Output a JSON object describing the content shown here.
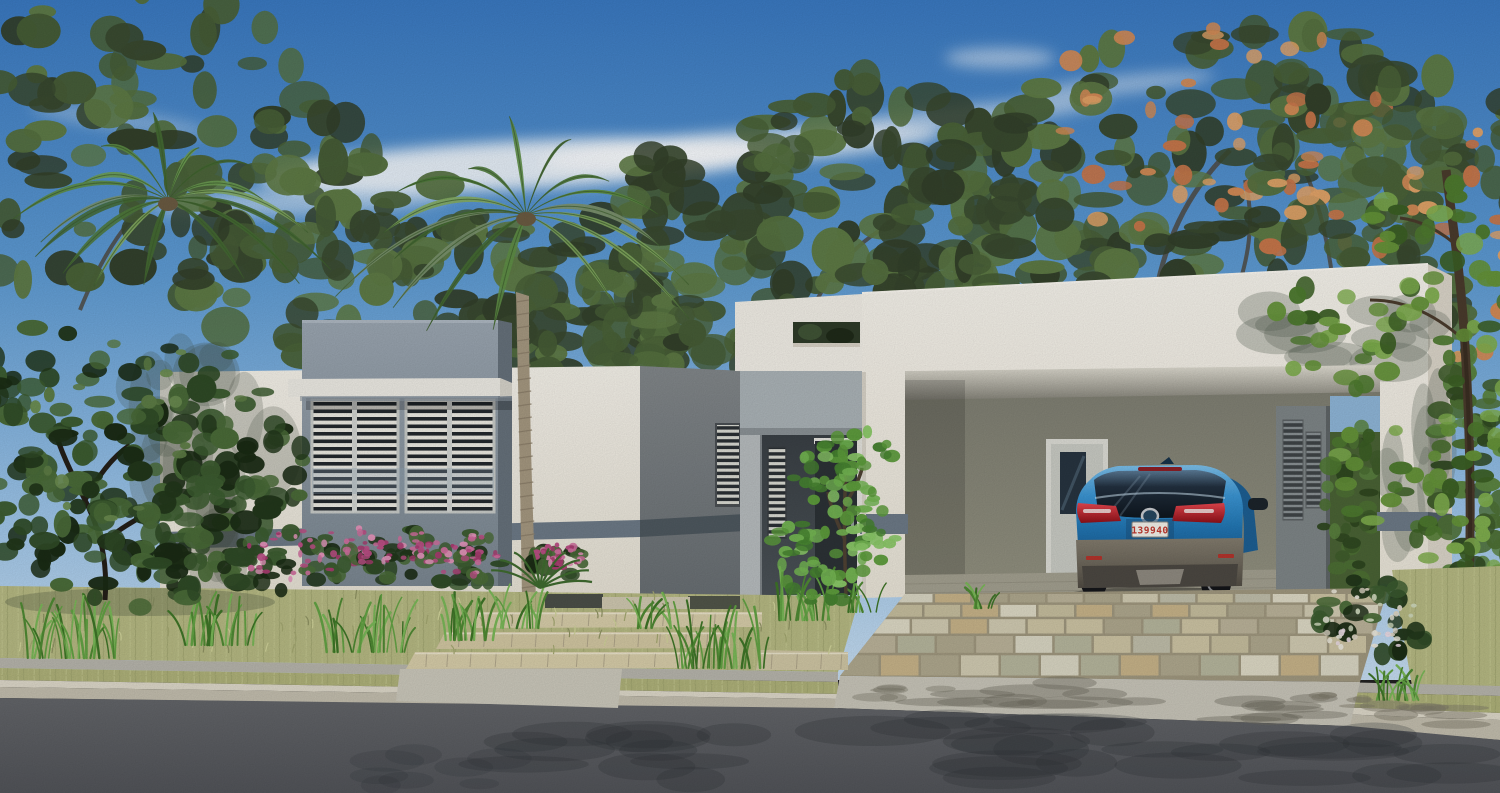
{
  "scene": {
    "type": "3d-architectural-exterior-render",
    "subject": "Modern flat-roof single-story house with louvered windows, entry porch, carport with parked blue SUV, palm trees, tropical landscaping, stone driveway and street",
    "car": {
      "kind": "blue compact SUV, rear view, parked in carport",
      "license_plate": "139940",
      "body_color": "#2f8ecd"
    },
    "palette": {
      "sky_top": "#3a79c1",
      "sky_horizon": "#c6ddf1",
      "wall_white": "#f2efe8",
      "accent_gray": "#94a0ab",
      "belt": "#6d7a87",
      "porch_gray": "#abb3b7",
      "alcove_dark": "#41474c",
      "door_charcoal": "#2c3236",
      "carport_back_wall": "#8b8b7f",
      "foliage_dark": "#2f4a26",
      "foliage_light": "#7fb95a",
      "flower_pink": "#cf6f9e",
      "flower_orange": "#d98e56",
      "palm_green": "#5a8a46",
      "trunk_tan": "#a59880",
      "lawn": "#b6b983",
      "stone_step": "#d7cda9",
      "concrete": "#c8c5b9",
      "curb": "#ddd8c9",
      "asphalt": "#5d5f63",
      "taillight_red": "#c0242c",
      "plate_text_red": "#c03a30"
    }
  }
}
